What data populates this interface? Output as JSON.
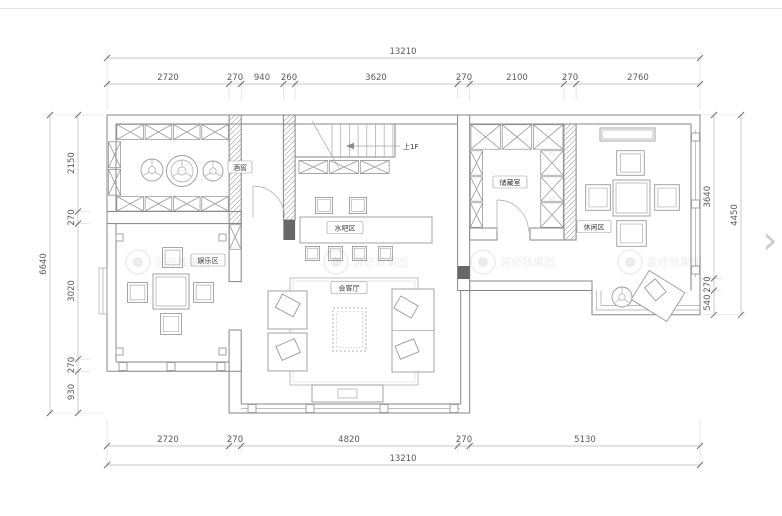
{
  "viewer": {
    "next_arrow": "›"
  },
  "watermark": {
    "label": "装修效果图"
  },
  "plan": {
    "rooms": {
      "wine_cellar": "酒窖",
      "water_bar": "水吧区",
      "entertainment": "娱乐区",
      "living": "会客厅",
      "storage": "储藏室",
      "leisure": "休闲区"
    },
    "stairs": {
      "note": "上1F"
    },
    "dimensions": {
      "top": {
        "total": "13210",
        "segments": [
          "2720",
          "270",
          "940",
          "260",
          "3620",
          "270",
          "2100",
          "270",
          "2760"
        ]
      },
      "bottom": {
        "total": "13210",
        "segments": [
          "2720",
          "270",
          "4820",
          "270",
          "5130"
        ]
      },
      "left": {
        "total": "6640",
        "segments": [
          "2150",
          "270",
          "3020",
          "270",
          "930"
        ]
      },
      "right": {
        "total": "4450",
        "segments": [
          "3640",
          "270",
          "540"
        ]
      }
    }
  }
}
